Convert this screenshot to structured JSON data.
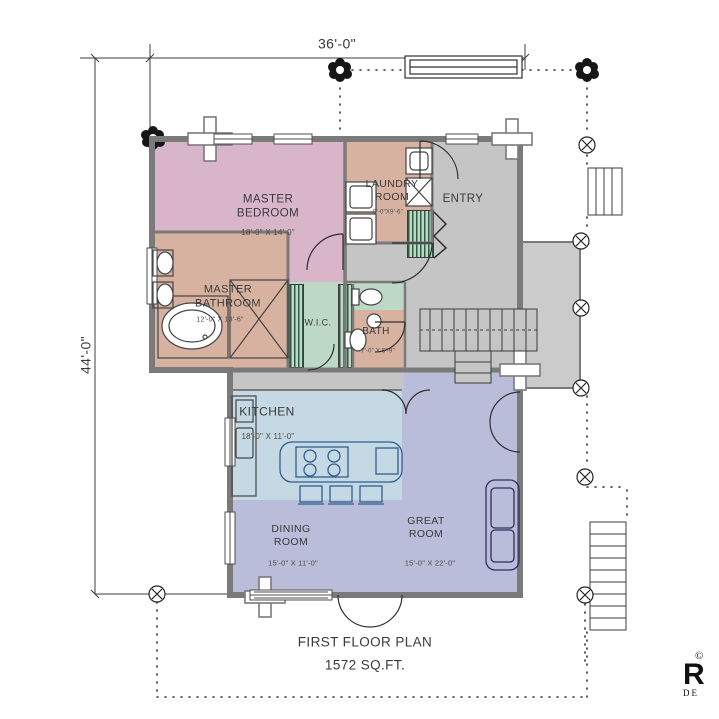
{
  "plan": {
    "title": "FIRST FLOOR PLAN",
    "area": "1572 SQ.FT.",
    "overall_width": "36'-0\"",
    "overall_height": "44'-0\""
  },
  "rooms": {
    "master_bedroom": {
      "label": "MASTER\nBEDROOM",
      "size": "18'-0\" X 14'-0\"",
      "color": "#d9b5ca"
    },
    "master_bathroom": {
      "label": "MASTER\nBATHROOM",
      "size": "12'-0\" X 13'-6\"",
      "color": "#d7b2a0"
    },
    "laundry": {
      "label": "LAUNDRY\nROOM",
      "size": "9'-0\"X9'-6\"",
      "color": "#d7b2a0"
    },
    "entry": {
      "label": "ENTRY",
      "color": "#c6c5c5"
    },
    "wic": {
      "label": "W.I.C.",
      "color": "#bdd8c5"
    },
    "bath": {
      "label": "BATH",
      "size": "7'-0\" X 5'-9\"",
      "color": "#d7b2a0"
    },
    "kitchen": {
      "label": "KITCHEN",
      "size": "18'-0\" X 11'-0\"",
      "color": "#c4d9e4"
    },
    "dining": {
      "label": "DINING\nROOM",
      "size": "15'-0\" X 11'-0\"",
      "color": "#b9bdd9"
    },
    "great_room": {
      "label": "GREAT\nROOM",
      "size": "15'-0\" X 22'-0\"",
      "color": "#b9bdd9"
    },
    "porch": {
      "color": "#cbcbcb"
    },
    "hall": {
      "color": "#c6c5c5"
    }
  },
  "logo": {
    "copyright": "©",
    "letter": "R",
    "text": "DE"
  }
}
